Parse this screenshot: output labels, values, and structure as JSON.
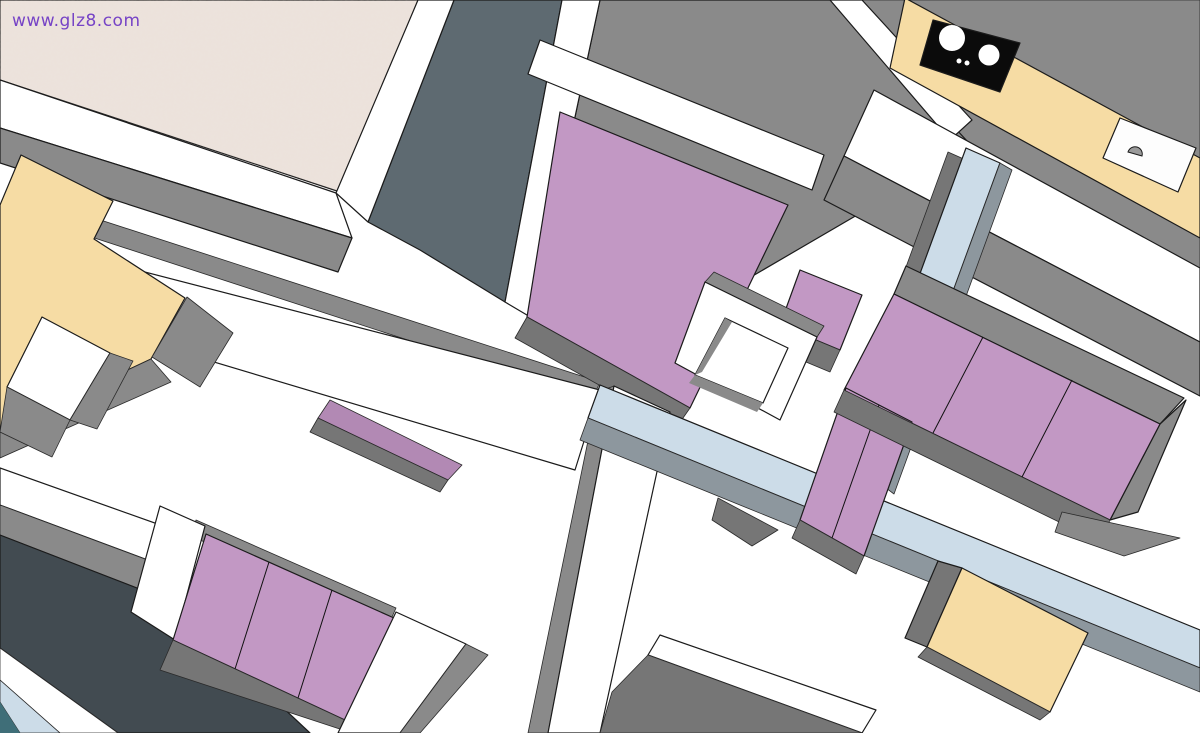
{
  "watermark": {
    "text": "www.glz8.com",
    "color": "#7643c6"
  },
  "palette": {
    "white": "#ffffff",
    "floor_texture_base": "#ece3dc",
    "wall_gray": "#8a8a8a",
    "wall_gray_dark": "#767676",
    "slate": "#5e6a71",
    "dark_slate": "#424b51",
    "purple": "#c298c4",
    "purple_dim": "#b289b4",
    "tan": "#f6dca4",
    "light_blue": "#ccdce8",
    "beam_side_gray": "#8d979e",
    "teal": "#3f6e78",
    "cooktop_black": "#0b0b0b",
    "sink_white": "#fdfdfd",
    "faucet_gray": "#9a9a9a",
    "outline": "#1b1b1b"
  },
  "scene": {
    "title": "3D apartment floor-plan overhead render",
    "objects": [
      {
        "name": "textured-carpet-floor",
        "label": "Textured carpet floor (top-left room)"
      },
      {
        "name": "perimeter-wall",
        "label": "White-topped gray partition walls"
      },
      {
        "name": "double-bed",
        "label": "Purple double bed (center bedroom)"
      },
      {
        "name": "bedside-seat",
        "label": "Purple bedside seat"
      },
      {
        "name": "square-side-table",
        "label": "White square side table (center)"
      },
      {
        "name": "kitchen-counter",
        "label": "Kitchen counter (top right)"
      },
      {
        "name": "cooktop",
        "label": "Black two-burner cooktop"
      },
      {
        "name": "kitchen-sink",
        "label": "Kitchen sink with faucet"
      },
      {
        "name": "sectional-sofa",
        "label": "L-shaped purple sectional sofa"
      },
      {
        "name": "coffee-table",
        "label": "Tan coffee table (bottom right)"
      },
      {
        "name": "corner-desk",
        "label": "Tan L-shaped desk (left)"
      },
      {
        "name": "small-white-table",
        "label": "Small white table (left)"
      },
      {
        "name": "three-seat-sofa",
        "label": "Purple three-seat sofa (bottom left)"
      },
      {
        "name": "balcony-floor",
        "label": "Dark balcony floor (bottom-left corner)"
      },
      {
        "name": "section-beam",
        "label": "Light-blue sectioned wall beams"
      }
    ]
  }
}
